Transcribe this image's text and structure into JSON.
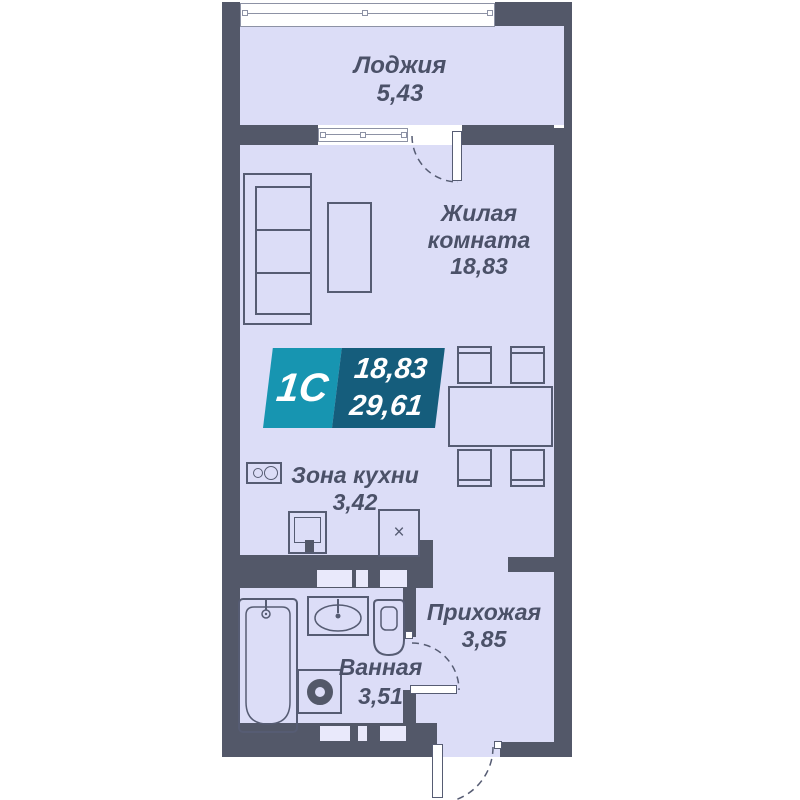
{
  "title": "Floor plan of studio apartment 1С",
  "badge": {
    "type": "1С",
    "living_area": "18,83",
    "total_area": "29,61"
  },
  "rooms": {
    "loggia": {
      "name": "Лоджия",
      "area": "5,43"
    },
    "living": {
      "name": "Жилая комната",
      "area": "18,83"
    },
    "kitchen": {
      "name": "Зона кухни",
      "area": "3,42"
    },
    "bathroom": {
      "name": "Ванная",
      "area": "3,51"
    },
    "hallway": {
      "name": "Прихожая",
      "area": "3,85"
    }
  },
  "marks": {
    "appliance": "×"
  },
  "colors": {
    "wall": "#535869",
    "room-fill": "#dcddf7",
    "vent-fill": "#e9e9fb",
    "outline": "#565c73",
    "text": "#4b5168",
    "badge-left": "#1795b1",
    "badge-right": "#155d7c",
    "window-border": "#8d92a5"
  }
}
